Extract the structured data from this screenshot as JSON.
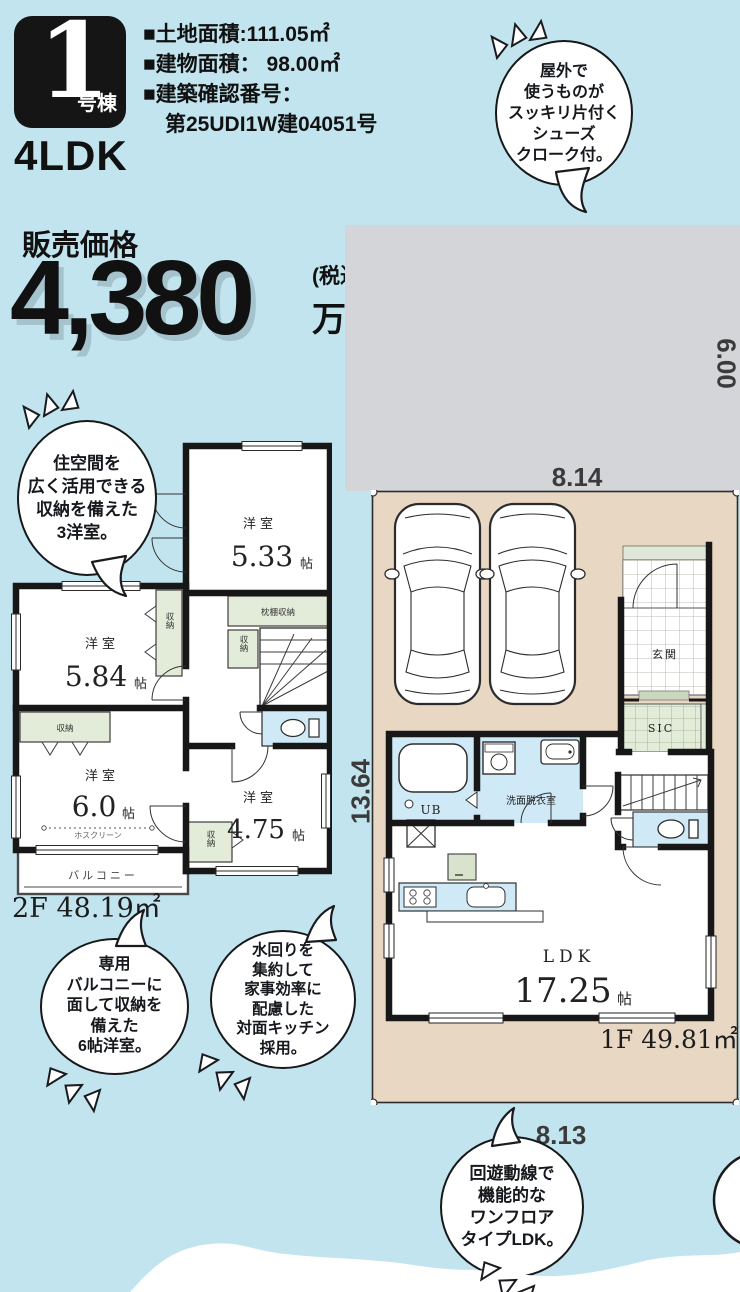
{
  "colors": {
    "background": "#c2e4ee",
    "plot_gray": "#d3d5d8",
    "site_beige": "#e8d7c3",
    "wall_black": "#171717",
    "water_blue": "#cfe9f6",
    "storage_green": "#e3ecd9",
    "badge_black": "#151515"
  },
  "header": {
    "badge_number": "1",
    "badge_suffix": "号棟",
    "plan_type": "4LDK",
    "specs": [
      "■土地面積:111.05㎡",
      "■建物面積： 98.00㎡",
      "■建築確認番号：",
      "第25UDI1W建04051号"
    ]
  },
  "price": {
    "label": "販売価格",
    "amount": "4,380",
    "tax_note": "(税込)",
    "unit": "万円"
  },
  "bubbles": {
    "shoes": {
      "lines": [
        "屋外で",
        "使うものが",
        "スッキリ片付く",
        "シューズ",
        "クローク付。"
      ]
    },
    "rooms": {
      "lines": [
        "住空間を",
        "広く活用できる",
        "収納を備えた",
        "3洋室。"
      ]
    },
    "balcony": {
      "lines": [
        "専用",
        "バルコニーに",
        "面して収納を",
        "備えた",
        "6帖洋室。"
      ]
    },
    "water": {
      "lines": [
        "水回りを",
        "集約して",
        "家事効率に",
        "配慮した",
        "対面キッチン",
        "採用。"
      ]
    },
    "ldk": {
      "lines": [
        "回遊動線で",
        "機能的な",
        "ワンフロア",
        "タイプLDK。"
      ]
    }
  },
  "plan2f": {
    "floor_label": "2F 48.19㎡",
    "rooms": {
      "r533_name": "洋室",
      "r533_num": "5.33",
      "r533_unit": "帖",
      "r584_name": "洋室",
      "r584_num": "5.84",
      "r584_unit": "帖",
      "r60_name": "洋室",
      "r60_num": "6.0",
      "r60_unit": "帖",
      "r475_name": "洋室",
      "r475_num": "4.75",
      "r475_unit": "帖"
    },
    "labels": {
      "closet": "収納",
      "shelf_closet": "枕棚収納",
      "hoscreen": "ホスクリーン",
      "balcony": "バルコニー"
    }
  },
  "plan1f": {
    "floor_label": "1F 49.81㎡",
    "rooms": {
      "entrance": "玄関",
      "sic": "SIC",
      "ub": "UB",
      "washroom": "洗面脱衣室",
      "ldk_name": "LDK",
      "ldk_num": "17.25",
      "ldk_unit": "帖"
    }
  },
  "dimensions": {
    "lot_depth": "6.00",
    "lot_width": "8.14",
    "site_depth_left": "13.64",
    "site_depth_right": "13.64",
    "site_width": "8.13"
  }
}
